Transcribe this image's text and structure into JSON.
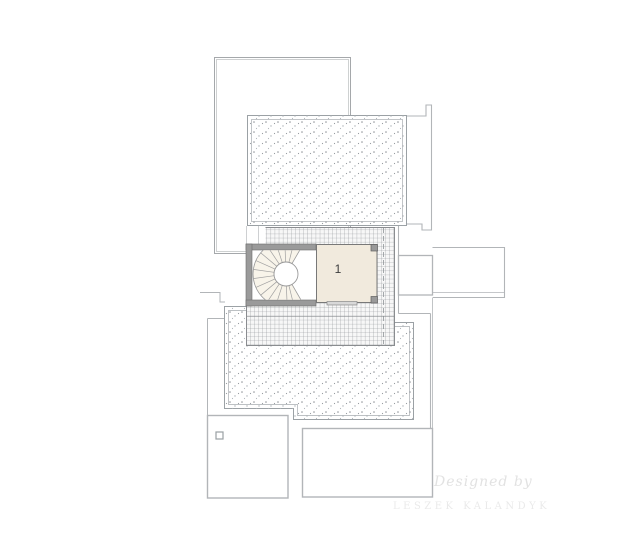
{
  "plan": {
    "type": "architectural-roof-plan",
    "room_label": "1",
    "areas": {
      "room": "interior room with spiral staircase",
      "upper_terrace": "stippled flat roof / terrace",
      "lower_terrace": "stippled flat roof / terrace",
      "tiled_area": "grid-hatched tiled roof band"
    },
    "colors": {
      "wall_fill": "#9a9a9a",
      "room_floor": "#f1eadd",
      "grid_line": "#878b8f",
      "outline_line": "#b2b5b8",
      "stipple_dot": "#8e9297"
    }
  },
  "watermark": {
    "line1": "Designed by",
    "line2": "LESZEK KALANDYK"
  }
}
